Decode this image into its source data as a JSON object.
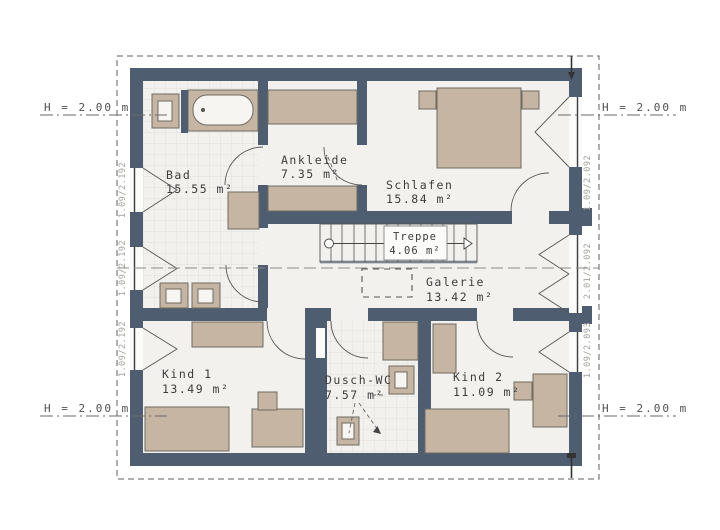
{
  "plan": {
    "rooms": [
      {
        "name": "Bad",
        "area": "15.55 m²"
      },
      {
        "name": "Ankleide",
        "area": "7.35 m²"
      },
      {
        "name": "Schlafen",
        "area": "15.84 m²"
      },
      {
        "name": "Treppe",
        "area": "4.06 m²"
      },
      {
        "name": "Galerie",
        "area": "13.42 m²"
      },
      {
        "name": "Kind 1",
        "area": "13.49 m²"
      },
      {
        "name": "Dusch-WC",
        "area": "7.57 m²"
      },
      {
        "name": "Kind 2",
        "area": "11.09 m²"
      }
    ],
    "height_labels": {
      "top_left": "H = 2.00 m",
      "top_right": "H = 2.00 m",
      "bottom_left": "H = 2.00 m",
      "bottom_right": "H = 2.00 m"
    },
    "window_dimensions": {
      "left": [
        "1.09/2.192",
        "1.09/2.192",
        "1.09/2.192"
      ],
      "right": [
        "1.09/2.092",
        "2.01/2.092",
        "1.09/2.093"
      ]
    },
    "colors": {
      "wall": "#4e5d70",
      "furniture": "#c7b5a4",
      "floor": "#f2f1ee",
      "tile_line": "#dcd7d0",
      "dim_text": "#a3a19c"
    }
  }
}
